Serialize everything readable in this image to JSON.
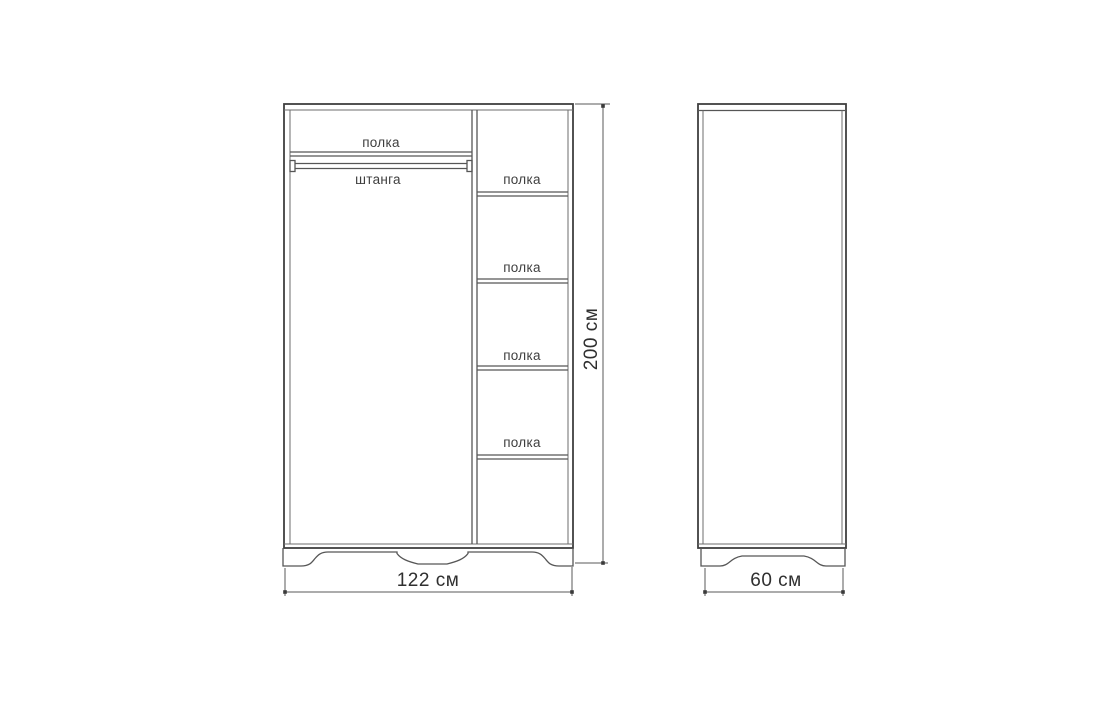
{
  "diagram": {
    "kind": "furniture-dimension-drawing",
    "colors": {
      "background": "#ffffff",
      "line_dark": "#3f3f3f",
      "line_mid": "#565656",
      "line_light": "#6e6e6e",
      "text": "#2f2f2f"
    },
    "front_view": {
      "shelf_top_label": "полка",
      "rod_label": "штанга",
      "right_shelf_labels": [
        "полка",
        "полка",
        "полка",
        "полка"
      ],
      "width_dimension": "122 см",
      "height_dimension": "200 см"
    },
    "side_view": {
      "depth_dimension": "60 см"
    }
  }
}
